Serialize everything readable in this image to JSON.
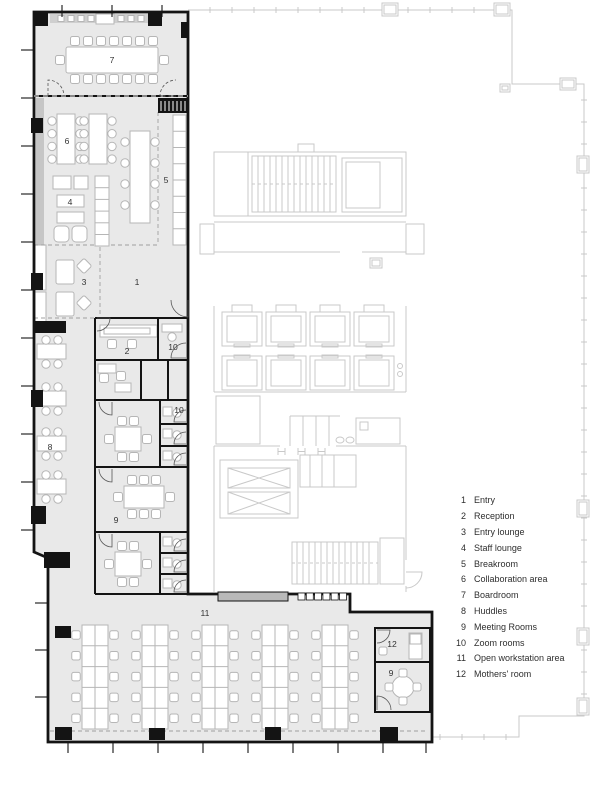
{
  "plan": {
    "title": "Office floor plan",
    "room_labels": [
      {
        "num": "7",
        "x": 112,
        "y": 60
      },
      {
        "num": "6",
        "x": 67,
        "y": 141
      },
      {
        "num": "5",
        "x": 166,
        "y": 180
      },
      {
        "num": "4",
        "x": 70,
        "y": 202
      },
      {
        "num": "3",
        "x": 84,
        "y": 282
      },
      {
        "num": "1",
        "x": 137,
        "y": 282
      },
      {
        "num": "2",
        "x": 127,
        "y": 351
      },
      {
        "num": "10",
        "x": 173,
        "y": 347
      },
      {
        "num": "10",
        "x": 179,
        "y": 410
      },
      {
        "num": "8",
        "x": 50,
        "y": 447
      },
      {
        "num": "9",
        "x": 116,
        "y": 520
      },
      {
        "num": "11",
        "x": 205,
        "y": 613
      },
      {
        "num": "12",
        "x": 392,
        "y": 644
      },
      {
        "num": "9",
        "x": 391,
        "y": 673
      }
    ],
    "colors": {
      "tenant_fill": "#e9e9e9",
      "wall": "#141414",
      "core_line": "#c9c9c9",
      "furniture_line": "#b6b6b6",
      "window_band": "#c6c6c6",
      "label_text": "#333333"
    }
  },
  "legend": {
    "items": [
      {
        "num": "1",
        "label": "Entry"
      },
      {
        "num": "2",
        "label": "Reception"
      },
      {
        "num": "3",
        "label": "Entry lounge"
      },
      {
        "num": "4",
        "label": "Staff lounge"
      },
      {
        "num": "5",
        "label": "Breakroom"
      },
      {
        "num": "6",
        "label": "Collaboration area"
      },
      {
        "num": "7",
        "label": "Boardroom"
      },
      {
        "num": "8",
        "label": "Huddles"
      },
      {
        "num": "9",
        "label": "Meeting Rooms"
      },
      {
        "num": "10",
        "label": "Zoom rooms"
      },
      {
        "num": "11",
        "label": "Open workstation area"
      },
      {
        "num": "12",
        "label": "Mothers' room"
      }
    ]
  }
}
